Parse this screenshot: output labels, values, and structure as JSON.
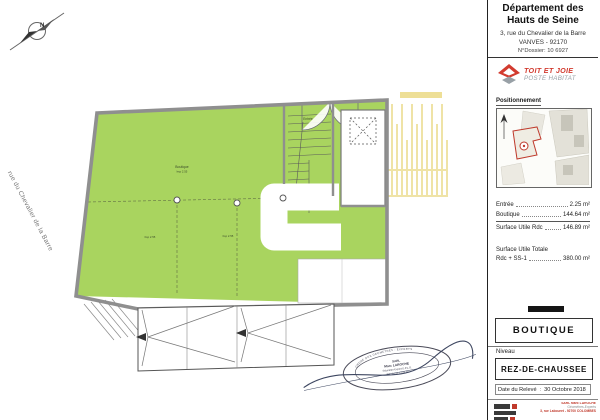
{
  "titleblock": {
    "title_line1": "Département des",
    "title_line2": "Hauts de Seine",
    "address": "3, rue du Chevalier de la Barre",
    "city_line": "VANVES - 92170",
    "dossier": "N°Dossier: 10 6927",
    "logo": {
      "line1": "TOIT ET JOIE",
      "line2": "POSTE HABITAT"
    },
    "positionnement_label": "Positionnement",
    "areas": {
      "rows": [
        {
          "label": "Entrée",
          "value": "2.25 m²"
        },
        {
          "label": "Boutique",
          "value": "144.64 m²"
        },
        {
          "label": "Surface Utile Rdc",
          "value": "146.89 m²"
        }
      ],
      "total_title": "Surface Utile Totale",
      "total_label": "Rdc + SS-1",
      "total_value": "380.00 m²"
    },
    "usage_label": "BOUTIQUE",
    "level_label": "Niveau",
    "level_value": "REZ-DE-CHAUSSEE",
    "date_label": "Date du Relevé",
    "date_value": "30 Octobre 2018",
    "firm": {
      "line1": "SARL Marc LAROCHE",
      "line2": "Géomètres-Experts",
      "line3": "3, rue Labouret - 92700 COLOMBES"
    }
  },
  "plan": {
    "street_label": "rue du Chevalier de la Barre",
    "compass_letter": "N",
    "labels": {
      "boutique": "Boutique",
      "boutique_sub": "hsp 2.55",
      "left_note": "hsp 2.55",
      "right_note": "hsp 2.55",
      "entree": "Entrée"
    },
    "stamp": {
      "arc_top": "ORDRE DES GEOMETRES - EXPERTS",
      "line1": "SARL",
      "line2": "Marc LAROCHE",
      "line3": "Géomètre-Expert D.P.L.G.",
      "line4": "Tél : 01 41 13 05 05"
    }
  },
  "colors": {
    "plan_green": "#a9d45f",
    "accent_red": "#d23b2f",
    "wall_gray": "#8f8f8f",
    "hatch_yellow": "#efe3a6"
  }
}
